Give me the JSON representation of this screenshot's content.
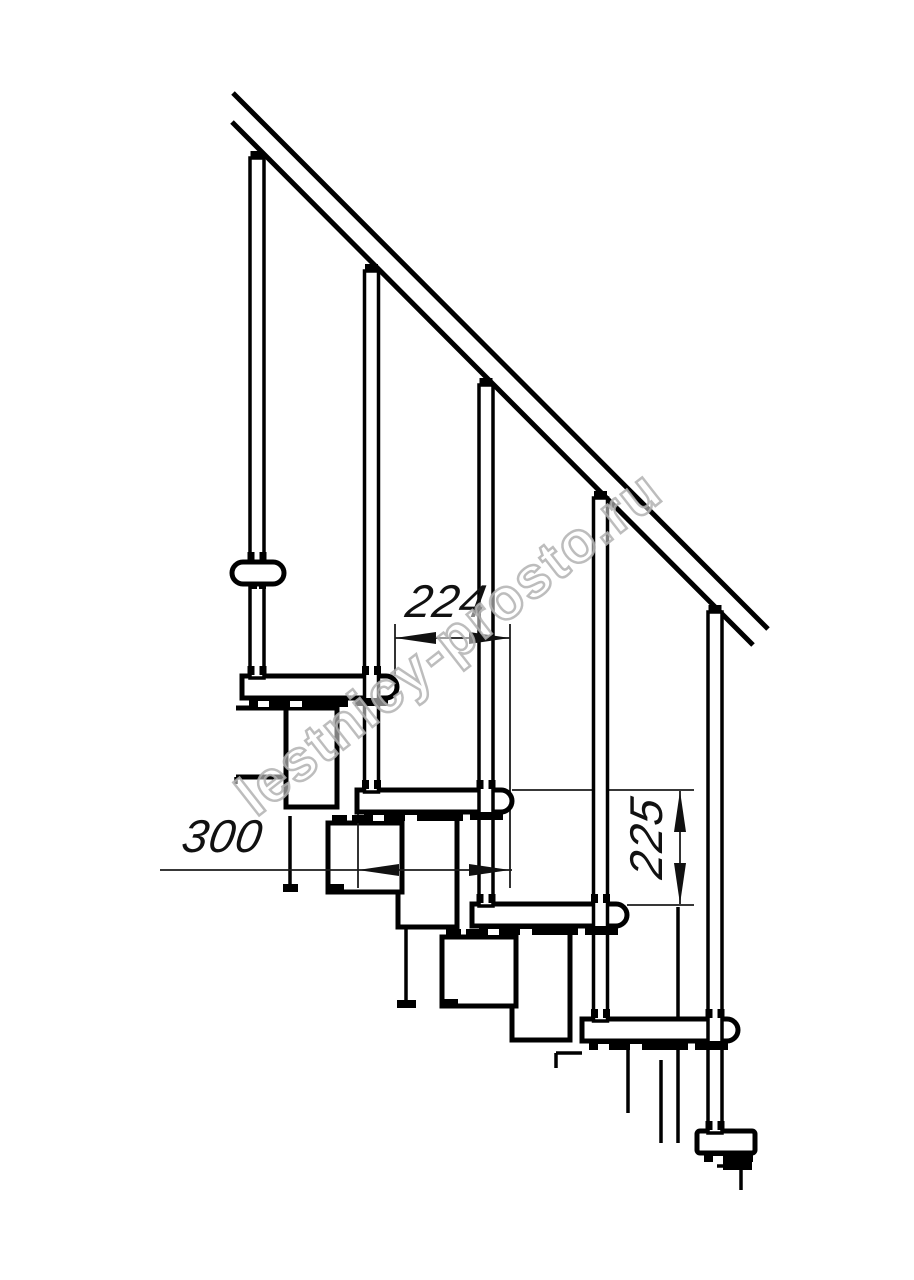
{
  "drawing": {
    "watermark": {
      "text": "lestnicy-prosto.ru"
    },
    "dimensions": {
      "going": {
        "label": "224"
      },
      "depth": {
        "label": "300"
      },
      "rise": {
        "label": "225"
      }
    },
    "colors": {
      "line": "#000000",
      "dimension": "#1c1c1c",
      "watermark_stroke": "#b2b2b2",
      "background": "#ffffff"
    }
  }
}
